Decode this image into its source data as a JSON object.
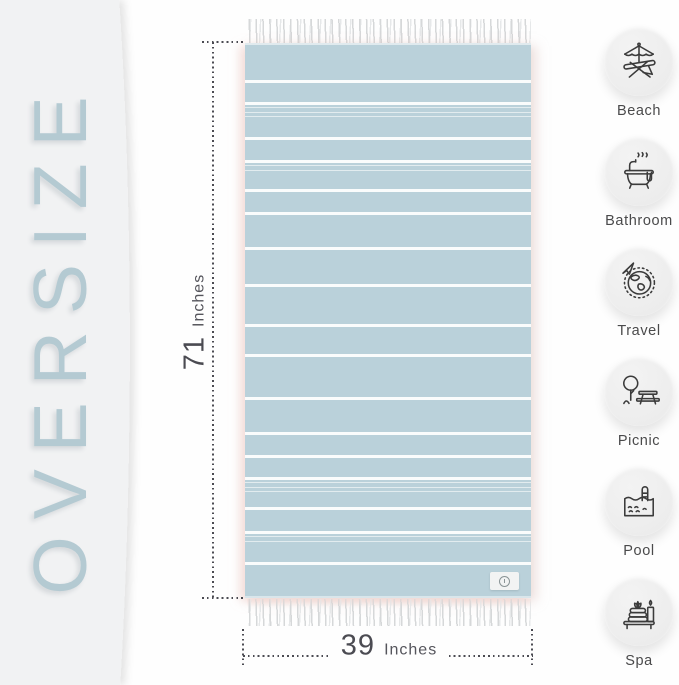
{
  "oversize": {
    "label": "OVERSIZE"
  },
  "dimensions": {
    "height": {
      "value": "71",
      "unit": "Inches"
    },
    "width": {
      "value": "39",
      "unit": "Inches"
    }
  },
  "towel": {
    "color": "#bad1da",
    "tag_icon": "brand-tag-logo",
    "stripes": [
      {
        "y": 35,
        "h": 3
      },
      {
        "y": 57,
        "h": 2.5
      },
      {
        "y": 62,
        "h": 1.4
      },
      {
        "y": 66.5,
        "h": 1.4
      },
      {
        "y": 71,
        "h": 1.4
      },
      {
        "y": 92,
        "h": 3
      },
      {
        "y": 115,
        "h": 2.5
      },
      {
        "y": 120,
        "h": 1.4
      },
      {
        "y": 124.5,
        "h": 1.4
      },
      {
        "y": 144,
        "h": 3
      },
      {
        "y": 167,
        "h": 3
      },
      {
        "y": 202,
        "h": 3
      },
      {
        "y": 239,
        "h": 3
      },
      {
        "y": 279,
        "h": 3
      },
      {
        "y": 309,
        "h": 3
      },
      {
        "y": 352,
        "h": 3
      },
      {
        "y": 387,
        "h": 3
      },
      {
        "y": 410,
        "h": 3
      },
      {
        "y": 432,
        "h": 2.5
      },
      {
        "y": 437,
        "h": 1.4
      },
      {
        "y": 441.5,
        "h": 1.4
      },
      {
        "y": 446,
        "h": 1.4
      },
      {
        "y": 462,
        "h": 3
      },
      {
        "y": 486,
        "h": 2.5
      },
      {
        "y": 491,
        "h": 1.4
      },
      {
        "y": 495.5,
        "h": 1.4
      },
      {
        "y": 517,
        "h": 3
      }
    ]
  },
  "use_cases": {
    "items": [
      {
        "icon": "beach-icon",
        "label": "Beach"
      },
      {
        "icon": "bathroom-icon",
        "label": "Bathroom"
      },
      {
        "icon": "travel-icon",
        "label": "Travel"
      },
      {
        "icon": "picnic-icon",
        "label": "Picnic"
      },
      {
        "icon": "pool-icon",
        "label": "Pool"
      },
      {
        "icon": "spa-icon",
        "label": "Spa"
      }
    ]
  },
  "colors": {
    "towel_blue": "#bad1da",
    "stripe_white": "#eef6f8",
    "oversize_text": "#b4cad2",
    "dimension_text": "#4b4b52",
    "panel_bg": "#f1f2f3",
    "icon_circle_bg": "#ececec",
    "icon_stroke": "#3b3b3b",
    "label_text": "#4a4a4b"
  }
}
